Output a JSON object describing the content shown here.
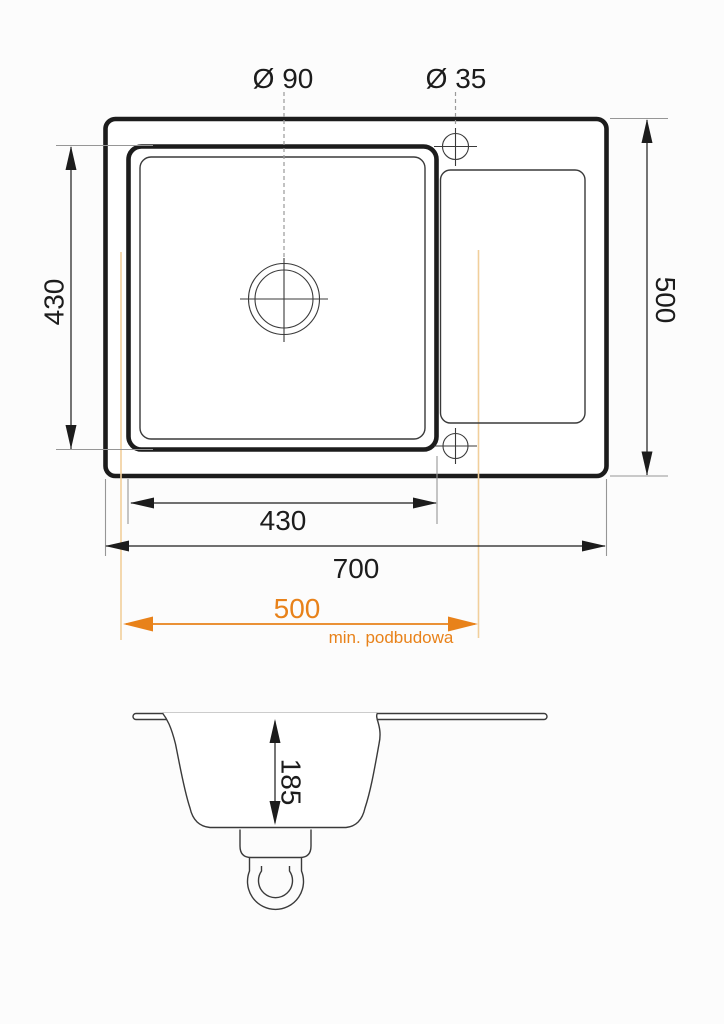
{
  "drawing": {
    "background": "#fcfcfc",
    "colors": {
      "background": "#fcfcfc",
      "ink": "#1c1c1c",
      "thin": "#3a3a3a",
      "ext": "#969696",
      "dash": "#9a9a9a",
      "accent": "#e8821a",
      "accent-pale": "#f1cf9b"
    },
    "top_view": {
      "hole_large_label": "Ø 90",
      "hole_small_label": "Ø 35",
      "basin_height": "430",
      "overall_depth": "500",
      "basin_width": "430",
      "overall_width": "700",
      "min_cabinet_width": "500",
      "min_cabinet_note": "min. podbudowa"
    },
    "section_view": {
      "bowl_depth": "185"
    }
  }
}
